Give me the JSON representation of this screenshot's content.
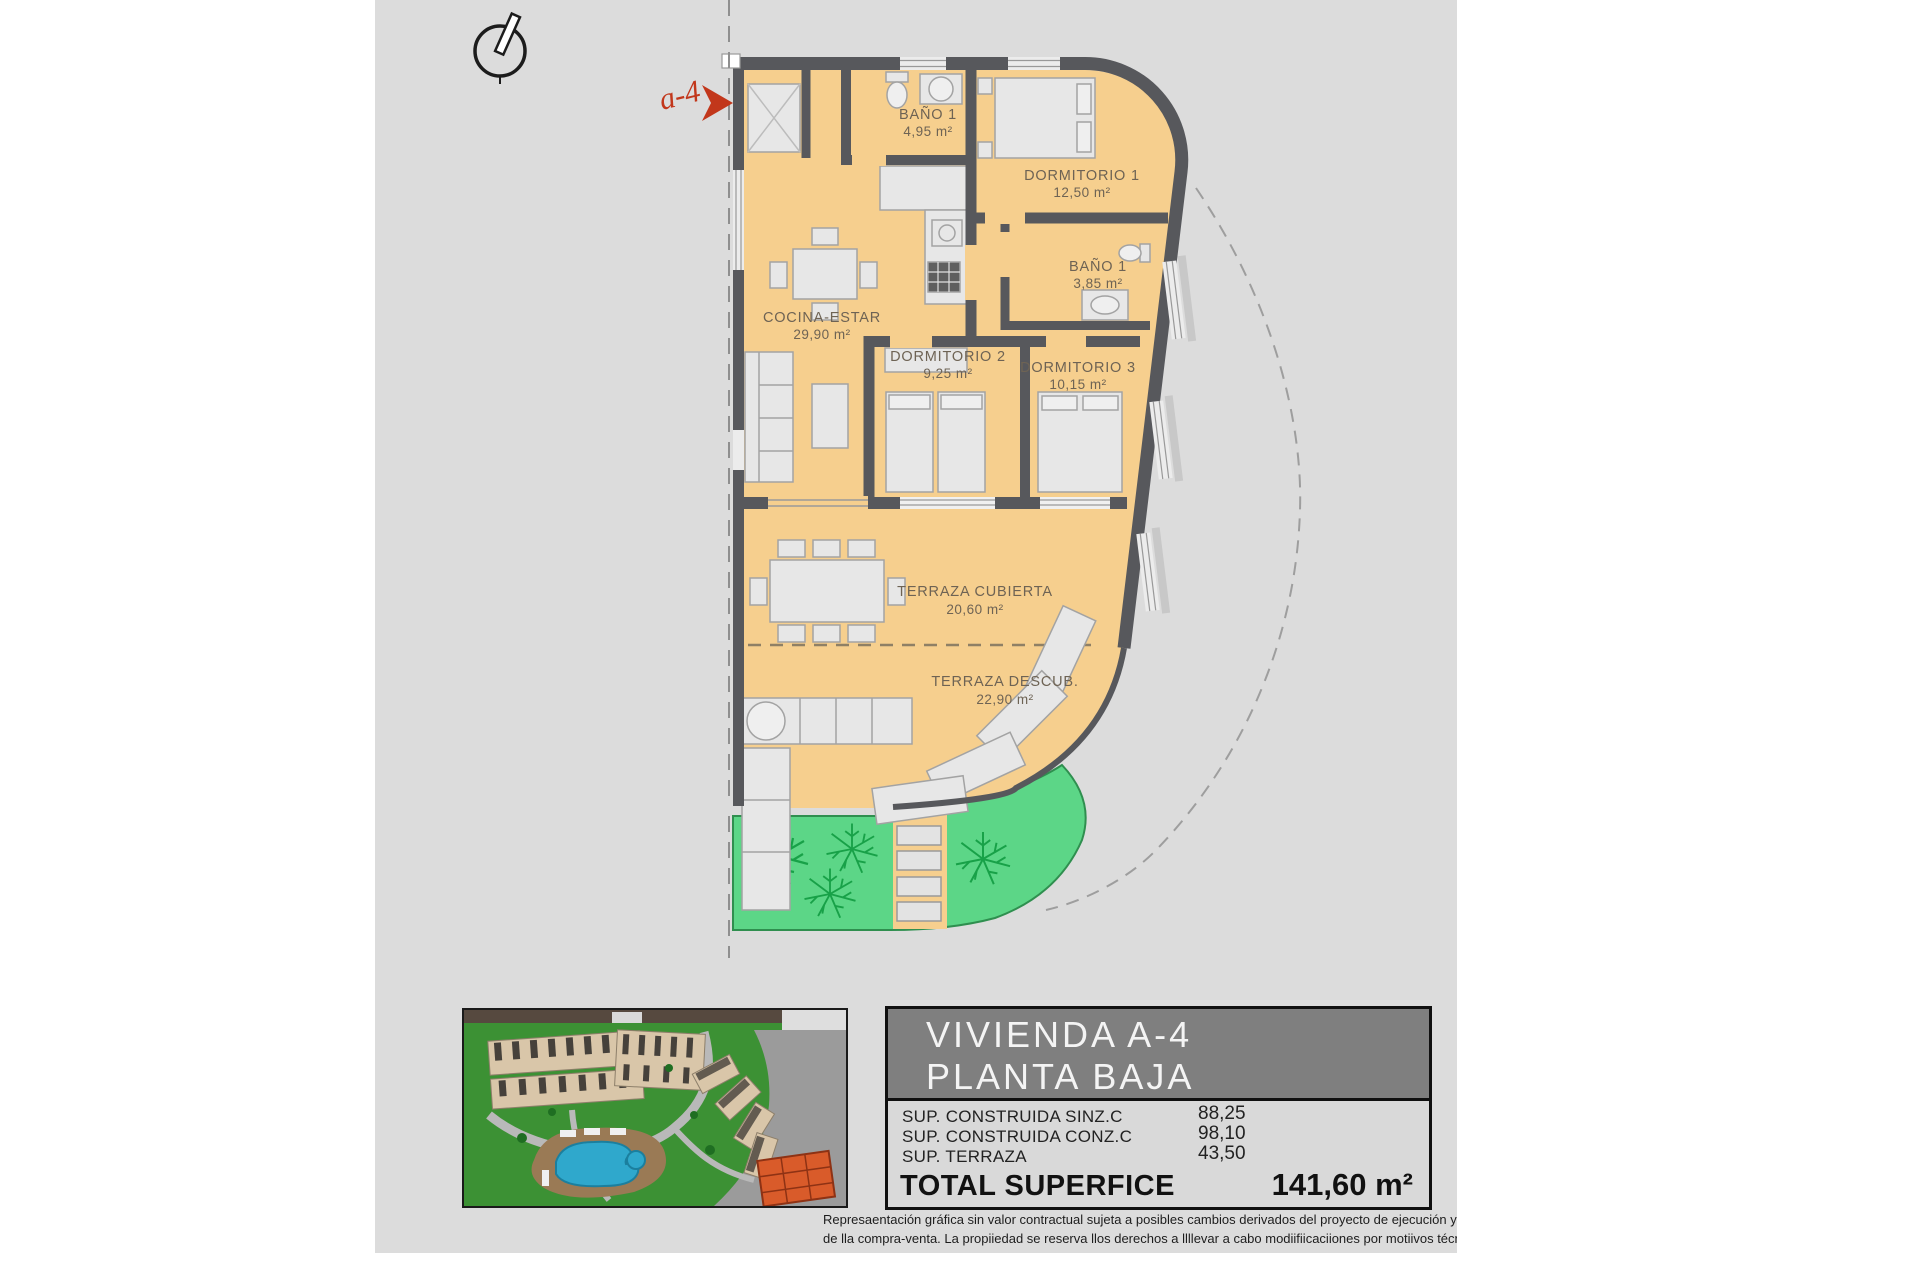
{
  "plan": {
    "unit_label": "a-4",
    "rooms": [
      {
        "name": "BAÑO 1",
        "area": "4,95 m²"
      },
      {
        "name": "DORMITORIO 1",
        "area": "12,50 m²"
      },
      {
        "name": "BAÑO 1",
        "area": "3,85 m²"
      },
      {
        "name": "COCINA-ESTAR",
        "area": "29,90 m²"
      },
      {
        "name": "DORMITORIO 2",
        "area": "9,25 m²"
      },
      {
        "name": "DORMITORIO 3",
        "area": "10,15 m²"
      },
      {
        "name": "TERRAZA CUBIERTA",
        "area": "20,60 m²"
      },
      {
        "name": "TERRAZA DESCUB.",
        "area": "22,90 m²"
      }
    ]
  },
  "title_block": {
    "title_line1": "VIVIENDA A-4",
    "title_line2": "PLANTA BAJA",
    "rows": [
      {
        "label": "SUP. CONSTRUIDA SINZ.C",
        "value": "88,25"
      },
      {
        "label": "SUP. CONSTRUIDA CONZ.C",
        "value": "98,10"
      },
      {
        "label": "SUP. TERRAZA",
        "value": "43,50"
      }
    ],
    "total_label": "TOTAL SUPERFICE",
    "total_value": "141,60 m²"
  },
  "disclaimer": {
    "line1": "Represaentación gráfica sin valor contractual sujeta a posibles cambios derivados del proyecto de ejecución y en cualquier caso será sustituido por el definitivo er",
    "line2": "de lla compra-venta. La propiiedad se reserva llos derechos a llllevar a cabo modiifiicaciiones por motiivos técniicos y cumplliiendo lla normatiiva viigente."
  },
  "colors": {
    "page_bg": "#dcdcdc",
    "floor": "#f6cf8e",
    "wall": "#57585c",
    "garden": "#5cd687",
    "tree": "#18a148",
    "accent_red": "#c2371b",
    "header_gray": "#7f7f7f",
    "pool_blue": "#2fa8cc",
    "highlight_unit": "#d95b2a"
  }
}
